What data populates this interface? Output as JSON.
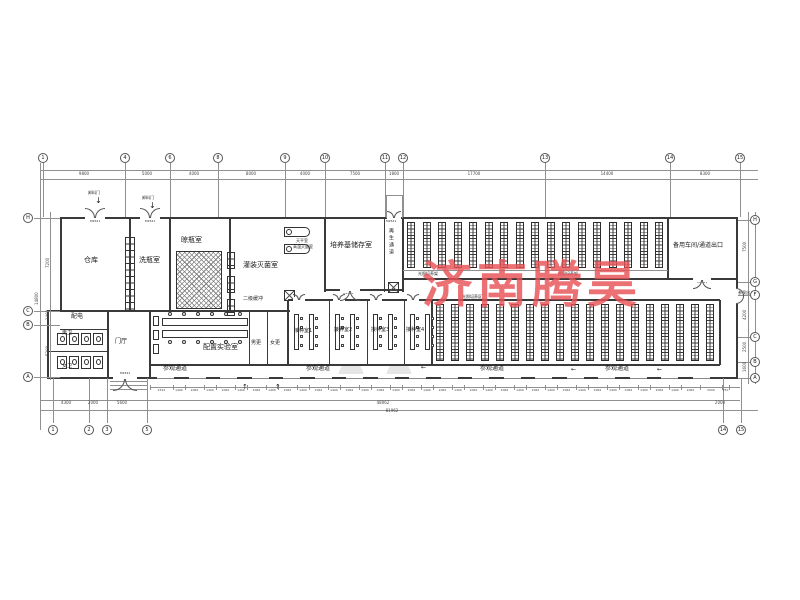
{
  "watermark": {
    "text": "济南腾昊",
    "color": "#e85257"
  },
  "drawing": {
    "labels": [
      {
        "id": "room-label-cangku",
        "t": "仓库",
        "x": 84,
        "y": 257,
        "fs": 7
      },
      {
        "id": "room-label-xipingshi",
        "t": "洗瓶室",
        "x": 139,
        "y": 257,
        "fs": 7
      },
      {
        "id": "room-label-liangpingshi",
        "t": "晾瓶室",
        "x": 181,
        "y": 237,
        "fs": 7
      },
      {
        "id": "room-label-guanzhuang",
        "t": "灌装灭菌室",
        "x": 243,
        "y": 262,
        "fs": 7
      },
      {
        "id": "room-label-peiyangji",
        "t": "培养基储存室",
        "x": 330,
        "y": 242,
        "fs": 7
      },
      {
        "id": "room-label-zaisheng",
        "t": "再生通道",
        "x": 388,
        "y": 228,
        "fs": 5,
        "cls": "vert"
      },
      {
        "id": "room-label-beiyong",
        "t": "备用车间/通道出口",
        "x": 673,
        "y": 243,
        "fs": 6
      },
      {
        "id": "room-label-peidian",
        "t": "配电",
        "x": 71,
        "y": 314,
        "fs": 6
      },
      {
        "id": "room-label-nanwei",
        "t": "男卫",
        "x": 62,
        "y": 331,
        "fs": 5
      },
      {
        "id": "room-label-nvwei",
        "t": "女卫",
        "x": 62,
        "y": 364,
        "fs": 5
      },
      {
        "id": "room-label-menting",
        "t": "门厅",
        "x": 115,
        "y": 339,
        "fs": 6
      },
      {
        "id": "room-label-erjihuanchong",
        "t": "二级缓冲",
        "x": 243,
        "y": 297,
        "fs": 5
      },
      {
        "id": "room-label-peizhi",
        "t": "配置实验室",
        "x": 203,
        "y": 344,
        "fs": 7
      },
      {
        "id": "room-label-nangeng",
        "t": "男更",
        "x": 251,
        "y": 341,
        "fs": 5
      },
      {
        "id": "room-label-nvgeng",
        "t": "女更",
        "x": 270,
        "y": 341,
        "fs": 5
      },
      {
        "id": "room-label-jiezhong-1",
        "t": "接种室1",
        "x": 294,
        "y": 329,
        "fs": 5
      },
      {
        "id": "room-label-jiezhong-2",
        "t": "接种室2",
        "x": 334,
        "y": 328,
        "fs": 5
      },
      {
        "id": "room-label-jiezhong-3",
        "t": "接种室3",
        "x": 371,
        "y": 328,
        "fs": 5
      },
      {
        "id": "room-label-jiezhong-4",
        "t": "接种室4",
        "x": 406,
        "y": 328,
        "fs": 5
      },
      {
        "id": "room-label-tianping",
        "t": "天平室",
        "x": 296,
        "y": 239,
        "fs": 4
      },
      {
        "id": "room-label-gaowen",
        "t": "高温灭菌室",
        "x": 293,
        "y": 245,
        "fs": 4
      },
      {
        "id": "zone-label-guangzhao-1",
        "t": "光照培养架",
        "x": 418,
        "y": 272,
        "fs": 4
      },
      {
        "id": "zone-label-guangzhao-2",
        "t": "光照培养架",
        "x": 558,
        "y": 272,
        "fs": 4
      },
      {
        "id": "zone-label-guangzhao-3",
        "t": "光照培养区",
        "x": 462,
        "y": 295,
        "fs": 4
      },
      {
        "id": "corridor-label-1",
        "t": "参观通道",
        "x": 163,
        "y": 366,
        "fs": 6
      },
      {
        "id": "corridor-label-2",
        "t": "参观通道",
        "x": 306,
        "y": 366,
        "fs": 6
      },
      {
        "id": "corridor-label-3",
        "t": "参观通道",
        "x": 480,
        "y": 366,
        "fs": 6
      },
      {
        "id": "corridor-label-4",
        "t": "参观通道",
        "x": 605,
        "y": 366,
        "fs": 6
      },
      {
        "id": "entrance-label",
        "t": "参观出入口",
        "x": 738,
        "y": 291,
        "fs": 4
      },
      {
        "id": "door-label-xieliao-1",
        "t": "卸料门",
        "x": 88,
        "y": 191,
        "fs": 4
      },
      {
        "id": "door-label-xieliao-2",
        "t": "卸料门",
        "x": 142,
        "y": 196,
        "fs": 4
      },
      {
        "id": "arrow-down-1",
        "t": "↓",
        "x": 95,
        "y": 197,
        "fs": 8
      },
      {
        "id": "arrow-down-2",
        "t": "↓",
        "x": 149,
        "y": 202,
        "fs": 8
      },
      {
        "id": "arrow-up-1",
        "t": "↑",
        "x": 242,
        "y": 384,
        "fs": 7
      },
      {
        "id": "arrow-up-2",
        "t": "↑",
        "x": 275,
        "y": 384,
        "fs": 7
      },
      {
        "id": "arrow-left-1",
        "t": "←",
        "x": 421,
        "y": 365,
        "fs": 6
      },
      {
        "id": "arrow-left-2",
        "t": "←",
        "x": 571,
        "y": 367,
        "fs": 6
      },
      {
        "id": "arrow-left-3",
        "t": "←",
        "x": 657,
        "y": 367,
        "fs": 6
      },
      {
        "id": "door-tag-1",
        "t": "M1521",
        "x": 90,
        "y": 220,
        "fs": 3
      },
      {
        "id": "door-tag-2",
        "t": "M1521",
        "x": 145,
        "y": 220,
        "fs": 3
      },
      {
        "id": "door-tag-3",
        "t": "M1521",
        "x": 386,
        "y": 220,
        "fs": 3
      },
      {
        "id": "door-tag-4",
        "t": "M1521",
        "x": 343,
        "y": 292,
        "fs": 3
      },
      {
        "id": "door-tag-5",
        "t": "M1521",
        "x": 697,
        "y": 281,
        "fs": 3
      },
      {
        "id": "door-tag-6",
        "t": "M1521",
        "x": 120,
        "y": 372,
        "fs": 3
      }
    ],
    "grid": {
      "top": [
        {
          "n": "1",
          "x": 43
        },
        {
          "n": "4",
          "x": 125
        },
        {
          "n": "6",
          "x": 170
        },
        {
          "n": "8",
          "x": 218
        },
        {
          "n": "9",
          "x": 285
        },
        {
          "n": "10",
          "x": 325
        },
        {
          "n": "11",
          "x": 385
        },
        {
          "n": "12",
          "x": 403
        },
        {
          "n": "13",
          "x": 545
        },
        {
          "n": "14",
          "x": 670
        },
        {
          "n": "15",
          "x": 740
        }
      ],
      "bottom": [
        {
          "n": "1",
          "x": 53
        },
        {
          "n": "2",
          "x": 89
        },
        {
          "n": "3",
          "x": 107
        },
        {
          "n": "5",
          "x": 147
        },
        {
          "n": "14",
          "x": 723
        },
        {
          "n": "15",
          "x": 741
        }
      ],
      "left": [
        {
          "n": "H",
          "y": 218
        },
        {
          "n": "C",
          "y": 311
        },
        {
          "n": "B",
          "y": 325
        },
        {
          "n": "A",
          "y": 377
        }
      ],
      "right": [
        {
          "n": "H",
          "y": 220
        },
        {
          "n": "G",
          "y": 282
        },
        {
          "n": "F",
          "y": 295
        },
        {
          "n": "C",
          "y": 337
        },
        {
          "n": "B",
          "y": 362
        },
        {
          "n": "A",
          "y": 378
        }
      ]
    },
    "dims": {
      "top": [
        {
          "t": "9800",
          "x": 84
        },
        {
          "t": "5000",
          "x": 147
        },
        {
          "t": "4000",
          "x": 194
        },
        {
          "t": "8000",
          "x": 251
        },
        {
          "t": "4000",
          "x": 305
        },
        {
          "t": "7500",
          "x": 355
        },
        {
          "t": "1800",
          "x": 394
        },
        {
          "t": "17700",
          "x": 474
        },
        {
          "t": "14400",
          "x": 607
        },
        {
          "t": "8300",
          "x": 705
        }
      ],
      "left": [
        {
          "t": "7200",
          "x": 46,
          "y": 268
        },
        {
          "t": "1400",
          "x": 46,
          "y": 320
        },
        {
          "t": "5200",
          "x": 46,
          "y": 356
        },
        {
          "t": "14800",
          "x": 35,
          "y": 305
        }
      ],
      "right": [
        {
          "t": "7500",
          "x": 743,
          "y": 252
        },
        {
          "t": "4200",
          "x": 743,
          "y": 320
        },
        {
          "t": "2500",
          "x": 743,
          "y": 352
        },
        {
          "t": "1600",
          "x": 743,
          "y": 372
        }
      ],
      "bottom_row1": [
        "2512",
        "1400",
        "2062",
        "1400",
        "2062",
        "1400",
        "2062",
        "1400",
        "2062",
        "1400",
        "2062",
        "1400",
        "2062",
        "1400",
        "2062",
        "1400",
        "2062",
        "1400",
        "2062",
        "1400",
        "2062",
        "1400",
        "2062",
        "1400",
        "2062",
        "1400",
        "2062",
        "1400",
        "2062",
        "1400",
        "2062",
        "1400",
        "2062",
        "1400",
        "2062",
        "2000",
        "750"
      ],
      "bottom_row2": [
        {
          "t": "4300",
          "x": 66
        },
        {
          "t": "2000",
          "x": 93
        },
        {
          "t": "5600",
          "x": 122
        },
        {
          "t": "48062",
          "x": 383
        },
        {
          "t": "2000",
          "x": 720
        }
      ],
      "totals": [
        {
          "t": "81962",
          "x": 392,
          "y": 409
        }
      ]
    }
  }
}
